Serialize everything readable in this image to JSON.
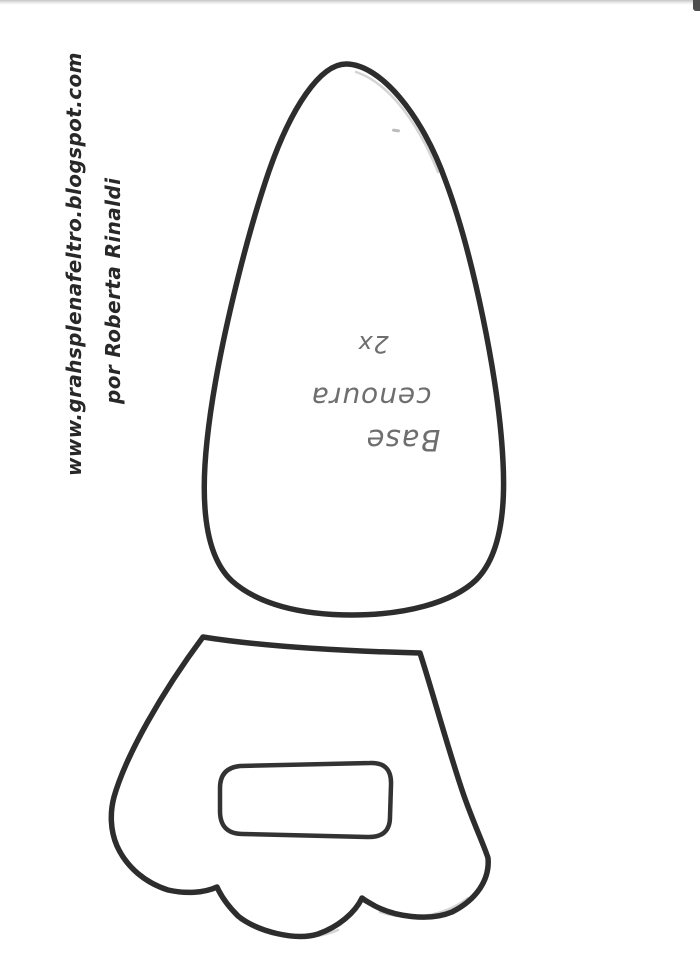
{
  "watermark": {
    "url": "www.grahsplenafeltro.blogspot.com",
    "credit": "por Roberta Rinaldi"
  },
  "carrot_base_label": {
    "title": "Base",
    "subject": "cenoura",
    "quantity": "2x"
  },
  "pieces": {
    "piece1_name": "base-cenoura-egg-shape",
    "piece2_name": "scalloped-piece-with-slot"
  },
  "colors": {
    "paper": "#ffffff",
    "marker_ink": "#2d2d2d",
    "pencil": "#6e6e6e"
  }
}
